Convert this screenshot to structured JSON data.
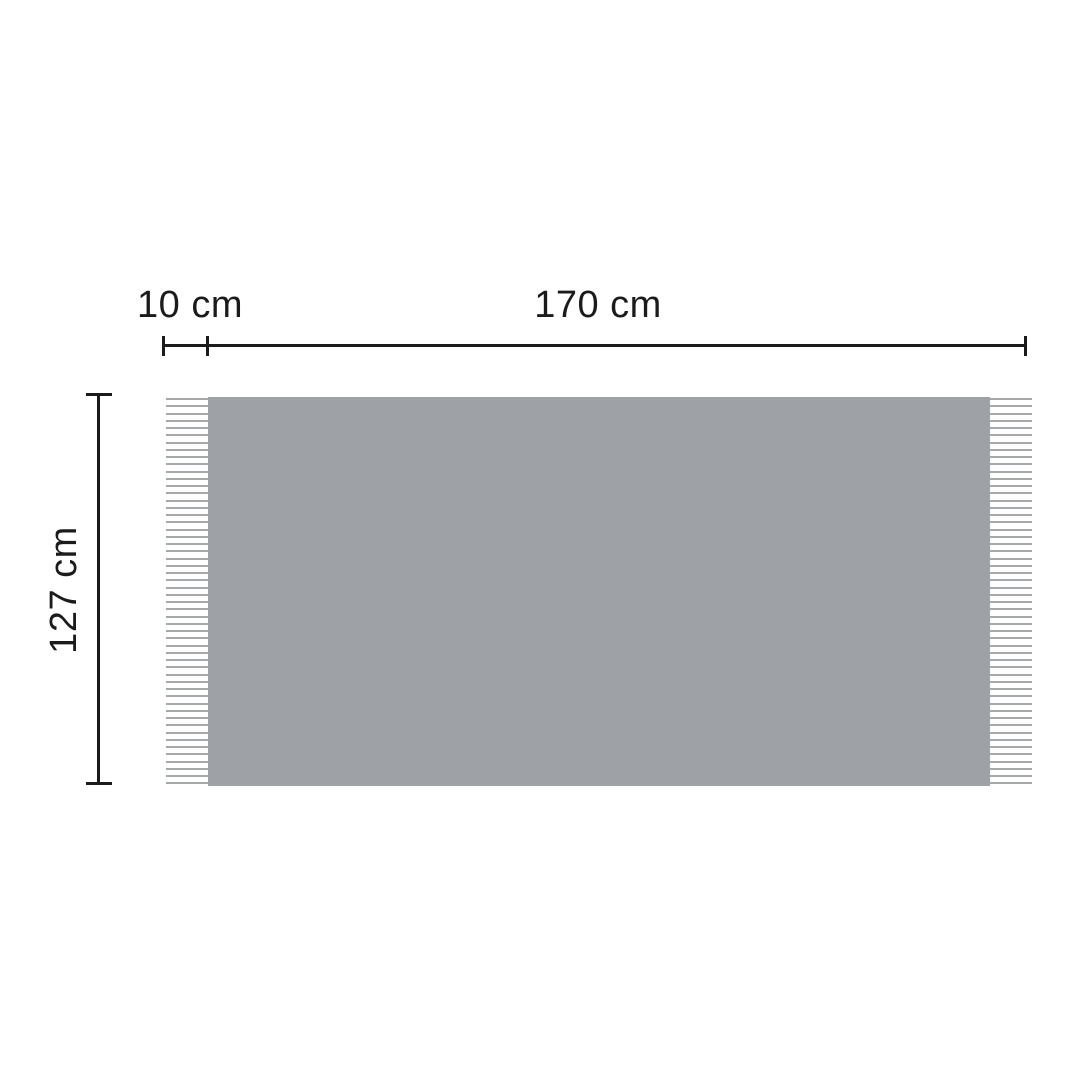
{
  "diagram": {
    "labels": {
      "fringe_width": "10 cm",
      "blanket_width": "170 cm",
      "blanket_height": "127 cm"
    },
    "colors": {
      "background": "#ffffff",
      "blanket": "#9ea1a5",
      "fringe": "#a6a8aa",
      "line": "#1b1b1b",
      "text": "#1b1b1b"
    },
    "fringes": {
      "line_count": 54
    }
  }
}
